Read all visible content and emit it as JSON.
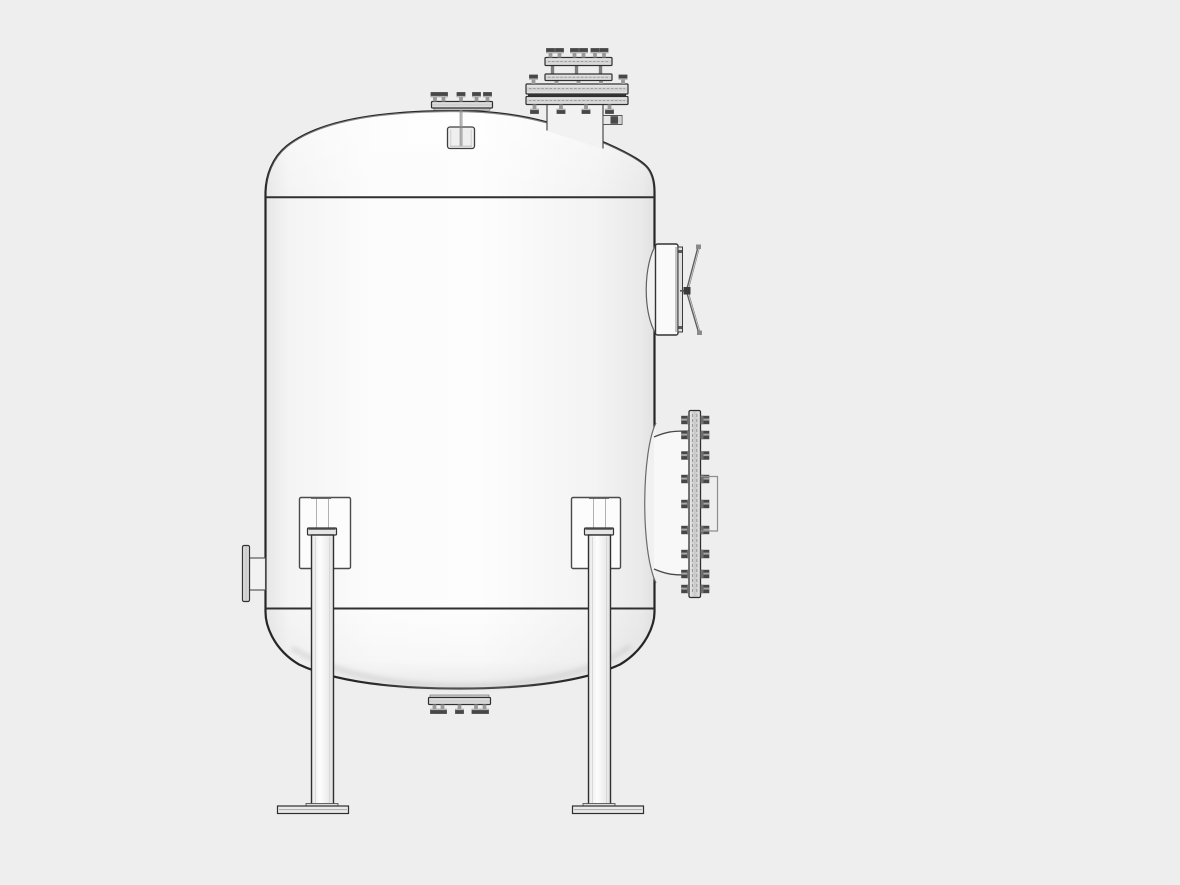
{
  "window": {
    "width_px": 1180,
    "height_px": 885
  },
  "scene": {
    "description": "Monochrome shaded 3D CAD render of a vertical pressure vessel on support legs, side elevation view, on a plain light-gray background. No text, labels or UI controls are visible.",
    "colors": {
      "background": "#eeeeee",
      "outline": "#262626",
      "seam": "#303030",
      "vessel-fill": "#fbfbfb",
      "hardware-light": "#e3e3e3",
      "hardware-mid": "#9a9a9a",
      "hardware-dark": "#474747"
    },
    "components": [
      {
        "name": "vessel-shell",
        "label": "Cylindrical shell"
      },
      {
        "name": "top-dished-head",
        "label": "Top dished head"
      },
      {
        "name": "bottom-dished-head",
        "label": "Bottom dished head"
      },
      {
        "name": "top-weld-seam",
        "label": "Upper circumferential weld seam"
      },
      {
        "name": "bottom-weld-seam",
        "label": "Lower circumferential weld seam"
      },
      {
        "name": "crown-nozzle",
        "label": "Top center studded nozzle flange"
      },
      {
        "name": "crown-lug",
        "label": "Lug below crown nozzle"
      },
      {
        "name": "top-flanged-riser",
        "label": "Top-right double bolted flange stack on riser neck"
      },
      {
        "name": "riser-side-tap",
        "label": "Small side tap on riser neck"
      },
      {
        "name": "upper-manway-cover",
        "label": "Mid-right blind cover with davit arms"
      },
      {
        "name": "lower-manway-flange",
        "label": "Lower-right bolted manway flange"
      },
      {
        "name": "left-nozzle",
        "label": "Left side flanged nozzle"
      },
      {
        "name": "bottom-nozzle",
        "label": "Bottom studded drain nozzle"
      },
      {
        "name": "support-leg-left",
        "label": "Left support leg with shell pad and base plate"
      },
      {
        "name": "support-leg-right",
        "label": "Right support leg with shell pad and base plate"
      }
    ]
  }
}
